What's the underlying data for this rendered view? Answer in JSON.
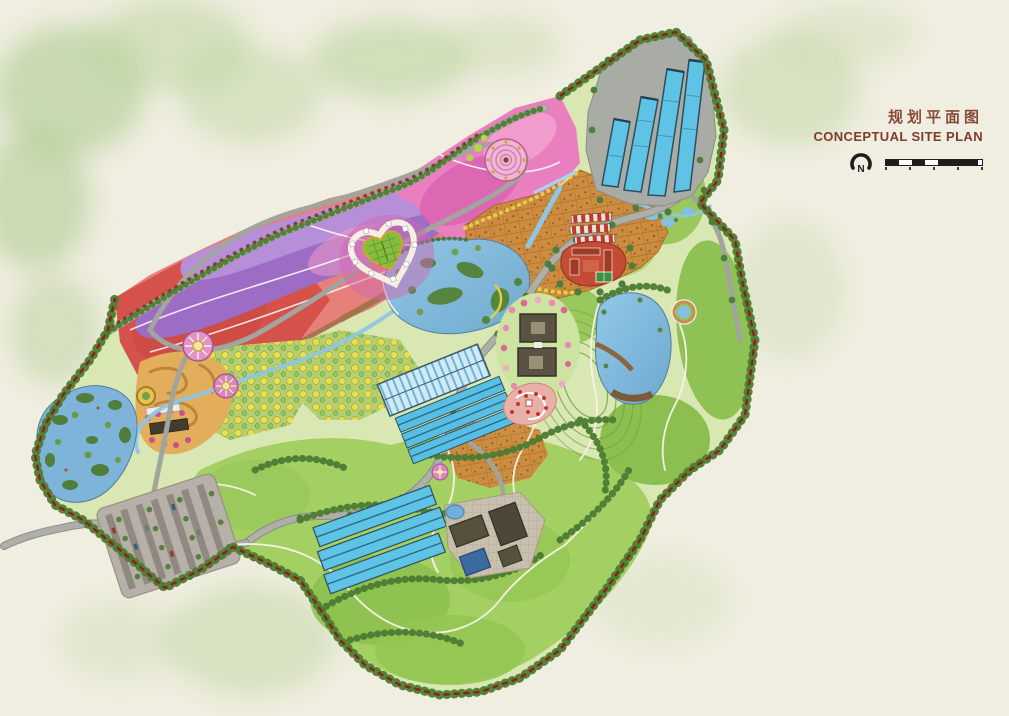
{
  "title_block": {
    "title_zh": "规划平面图",
    "title_en": "CONCEPTUAL SITE PLAN",
    "north_label": "N"
  },
  "colors": {
    "background": "#f0eee0",
    "title_text": "#7e3b2e",
    "boundary_dash": "#8e2014",
    "forest_fringe": "#4c7c33",
    "meadow_green": "#a4cf62",
    "flower_red": "#d5524b",
    "flower_salmon": "#e7807a",
    "flower_purple": "#9d6cc5",
    "flower_violet": "#b78fd9",
    "flower_pink": "#ea7fc0",
    "water_blue": "#7fb8df",
    "greenhouse_blue": "#5fc3e6",
    "orchard_terrace_orange": "#cf8a3e",
    "orchard_dot_yellow": "#e9e14e",
    "road_gray": "#adafa8",
    "trail_white": "#f7f4e8",
    "parking_pad": "#b6b0a8",
    "building_dark": "#5a5344",
    "building_red": "#c44b34",
    "plaza_paving": "#c9bfae"
  },
  "features": [
    "site-boundary",
    "flower-field-bands",
    "heart-garden",
    "spiral-plaza",
    "flower-mandalas",
    "north-greenhouses",
    "terraced-orchard",
    "cabin-rows",
    "red-courtyard-complex",
    "central-lake",
    "east-lake",
    "west-wetland-lake",
    "dark-courtyard-buildings",
    "central-greenhouses",
    "red-flower-garden",
    "south-greenhouses",
    "service-plaza",
    "parking-lot",
    "meadow-hills",
    "forest-ridges",
    "roads",
    "trails",
    "streams"
  ]
}
